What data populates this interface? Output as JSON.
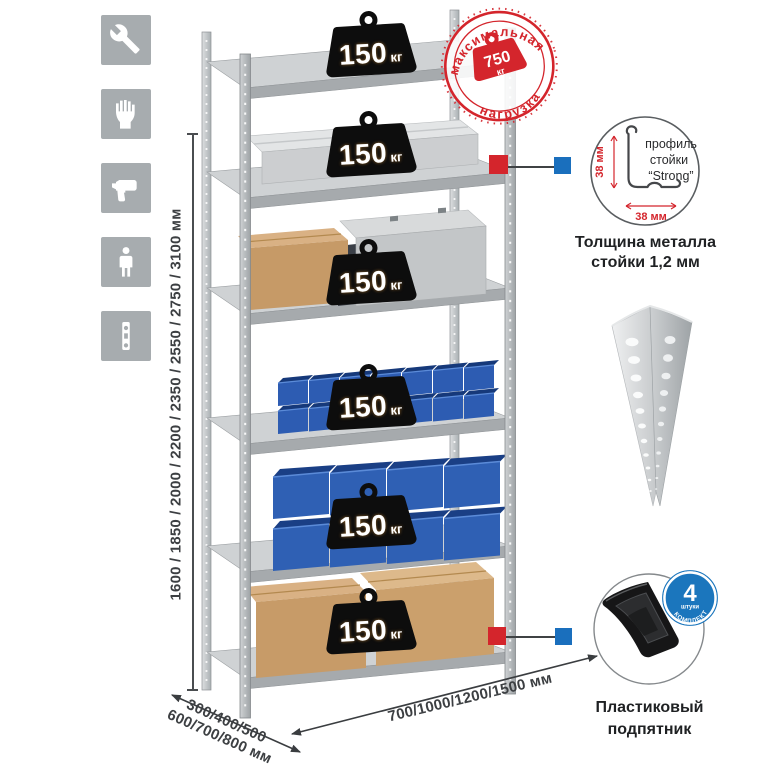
{
  "colors": {
    "accent_red": "#d4252c",
    "accent_blue": "#1a6fbd",
    "icon_gray": "#a7acaf",
    "bin_blue": "#2f5fb4",
    "metal_gray": "#c3c6c9"
  },
  "tool_icons": [
    {
      "name": "wrench-icon"
    },
    {
      "name": "gloves-icon"
    },
    {
      "name": "drill-icon"
    },
    {
      "name": "person-icon"
    },
    {
      "name": "level-icon"
    }
  ],
  "rack": {
    "shelves": [
      {
        "load": "150",
        "unit": "кг"
      },
      {
        "load": "150",
        "unit": "кг"
      },
      {
        "load": "150",
        "unit": "кг"
      },
      {
        "load": "150",
        "unit": "кг"
      },
      {
        "load": "150",
        "unit": "кг"
      },
      {
        "load": "150",
        "unit": "кг"
      }
    ]
  },
  "max_load_stamp": {
    "arc_top": "максимальная",
    "arc_bottom": "нагрузка",
    "value": "750",
    "unit": "кг"
  },
  "height_dim": {
    "label": "1600 / 1850 / 2000 / 2200 / 2350 / 2550 / 2750 / 3100 мм"
  },
  "width_dim": {
    "label": "700/1000/1200/1500 мм"
  },
  "depth_dim": {
    "line1": "300/400/500",
    "line2": "600/700/800 мм"
  },
  "profile_callout": {
    "text1": "профиль",
    "text2": "стойки",
    "text3": "“Strong”",
    "vdim": "38 мм",
    "hdim": "38 мм",
    "caption1": "Толщина металла",
    "caption2": "стойки 1,2 мм"
  },
  "foot_callout": {
    "count": "4",
    "count_unit": "штуки",
    "arc": "В КОМПЛЕКТЕ",
    "caption1": "Пластиковый",
    "caption2": "подпятник"
  }
}
